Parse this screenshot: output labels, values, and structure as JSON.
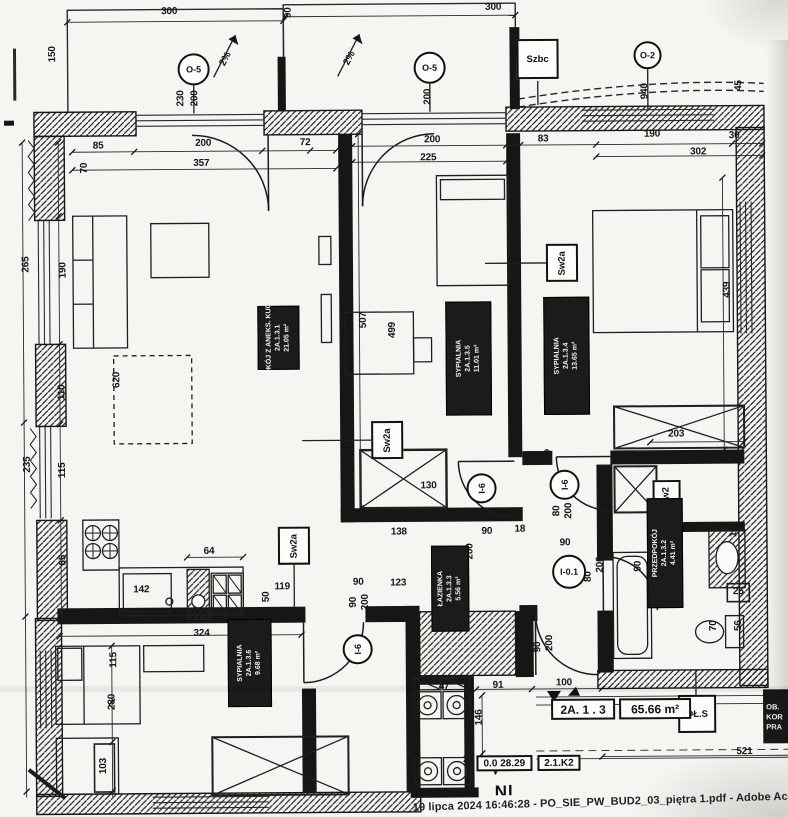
{
  "footer": "19 lipca 2024 16:46:28 - PO_SIE_PW_BUD2_03_piętra 1.pdf - Adobe Acrobat Read",
  "apartment": {
    "unit": "2A. 1 . 3",
    "area": "65.66 m²"
  },
  "marks": {
    "elevation_prefix": "0.0",
    "elevation_value": "28.29",
    "section_tag": "2.1.K2",
    "clipped_text": "Nl",
    "edge_stamp": [
      "OB.",
      "KOR",
      "PRA"
    ]
  },
  "plan": {
    "room_labels": [
      {
        "lines": [
          "POKÓJ Z ANEKS. KUCH.",
          "2A.1.3.1",
          "21.05 m²"
        ],
        "x": 258,
        "y": 305,
        "w": 42,
        "h": 64
      },
      {
        "lines": [
          "SYPIALNIA",
          "2A.1.3.5",
          "11.01 m²"
        ],
        "x": 446,
        "y": 302,
        "w": 46,
        "h": 114
      },
      {
        "lines": [
          "SYPIALNIA",
          "2A.1.3.4",
          "13.65 m²"
        ],
        "x": 544,
        "y": 298,
        "w": 46,
        "h": 118
      },
      {
        "lines": [
          "ŁAZIENKA",
          "2A.1.3.3",
          "5.56 m²"
        ],
        "x": 430,
        "y": 546,
        "w": 38,
        "h": 86
      },
      {
        "lines": [
          "PRZEDPOKÓJ",
          "2A.1.3.2",
          "4.41 m²"
        ],
        "x": 646,
        "y": 500,
        "w": 36,
        "h": 110
      },
      {
        "lines": [
          "SYPIALNIA",
          "2A.1.3.6",
          "9.68 m²"
        ],
        "x": 226,
        "y": 618,
        "w": 44,
        "h": 88
      }
    ],
    "square_tags": [
      {
        "t": "Szbc",
        "x": 540,
        "y": 60,
        "w": 42,
        "h": 40,
        "rot": 0
      },
      {
        "t": "Sw2a",
        "x": 563,
        "y": 264,
        "w": 32,
        "h": 38,
        "rot": -90
      },
      {
        "t": "Sw2a",
        "x": 387,
        "y": 440,
        "w": 32,
        "h": 38,
        "rot": -90
      },
      {
        "t": "Sw2a",
        "x": 293,
        "y": 545,
        "w": 32,
        "h": 38,
        "rot": -90
      },
      {
        "t": "Sw2",
        "x": 666,
        "y": 498,
        "w": 28,
        "h": 32,
        "rot": -90
      },
      {
        "t": "DŁ.S",
        "x": 695,
        "y": 716,
        "w": 38,
        "h": 38,
        "rot": 0
      }
    ],
    "circle_tags": [
      {
        "t": "O-5",
        "x": 196,
        "y": 68,
        "d": 32,
        "rot": 0
      },
      {
        "t": "O-5",
        "x": 432,
        "y": 68,
        "d": 32,
        "rot": 0
      },
      {
        "t": "O-2",
        "x": 650,
        "y": 57,
        "d": 28,
        "rot": 0
      },
      {
        "t": "I-6",
        "x": 481,
        "y": 489,
        "d": 30,
        "rot": -90
      },
      {
        "t": "I-6",
        "x": 564,
        "y": 486,
        "d": 30,
        "rot": -90
      },
      {
        "t": "I-6",
        "x": 356,
        "y": 649,
        "d": 30,
        "rot": -90
      },
      {
        "t": "I-0.1",
        "x": 568,
        "y": 573,
        "d": 34,
        "rot": 0
      }
    ],
    "dimensions": [
      {
        "t": "300",
        "x": 172,
        "y": 10
      },
      {
        "t": "90",
        "x": 291,
        "y": 12,
        "r": -90
      },
      {
        "t": "300",
        "x": 496,
        "y": 8
      },
      {
        "t": "150",
        "x": 55,
        "y": 52,
        "r": -90
      },
      {
        "t": "2%",
        "x": 228,
        "y": 58,
        "r": -62
      },
      {
        "t": "2%",
        "x": 352,
        "y": 58,
        "r": -62
      },
      {
        "t": "230",
        "x": 183,
        "y": 97,
        "r": -90
      },
      {
        "t": "200",
        "x": 197,
        "y": 97,
        "r": -90
      },
      {
        "t": "200",
        "x": 430,
        "y": 97,
        "r": -90
      },
      {
        "t": "940",
        "x": 647,
        "y": 93,
        "r": -90
      },
      {
        "t": "45",
        "x": 741,
        "y": 88,
        "r": -90
      },
      {
        "t": "85",
        "x": 100,
        "y": 144
      },
      {
        "t": "200",
        "x": 205,
        "y": 142
      },
      {
        "t": "72",
        "x": 307,
        "y": 142
      },
      {
        "t": "25",
        "x": 345,
        "y": 144
      },
      {
        "t": "200",
        "x": 434,
        "y": 140
      },
      {
        "t": "83",
        "x": 545,
        "y": 140
      },
      {
        "t": "190",
        "x": 654,
        "y": 136
      },
      {
        "t": "30",
        "x": 736,
        "y": 138
      },
      {
        "t": "70",
        "x": 86,
        "y": 166,
        "r": -90
      },
      {
        "t": "357",
        "x": 203,
        "y": 162
      },
      {
        "t": "225",
        "x": 430,
        "y": 158
      },
      {
        "t": "302",
        "x": 700,
        "y": 154
      },
      {
        "t": "265",
        "x": 27,
        "y": 262,
        "r": -90
      },
      {
        "t": "190",
        "x": 64,
        "y": 268,
        "r": -90
      },
      {
        "t": "620",
        "x": 117,
        "y": 378,
        "r": -90
      },
      {
        "t": "110",
        "x": 62,
        "y": 390,
        "r": -90
      },
      {
        "t": "235",
        "x": 27,
        "y": 462,
        "r": -90
      },
      {
        "t": "115",
        "x": 62,
        "y": 468,
        "r": -90
      },
      {
        "t": "65",
        "x": 62,
        "y": 558,
        "r": -90
      },
      {
        "t": "507",
        "x": 364,
        "y": 320,
        "r": -90
      },
      {
        "t": "499",
        "x": 393,
        "y": 330,
        "r": -90
      },
      {
        "t": "439",
        "x": 728,
        "y": 292,
        "r": -90
      },
      {
        "t": "203",
        "x": 676,
        "y": 436
      },
      {
        "t": "130",
        "x": 428,
        "y": 486
      },
      {
        "t": "60",
        "x": 546,
        "y": 456,
        "r": -48
      },
      {
        "t": "138",
        "x": 398,
        "y": 532
      },
      {
        "t": "90",
        "x": 486,
        "y": 532
      },
      {
        "t": "18",
        "x": 519,
        "y": 530
      },
      {
        "t": "80",
        "x": 456,
        "y": 552,
        "r": -90
      },
      {
        "t": "200",
        "x": 469,
        "y": 552,
        "r": -90
      },
      {
        "t": "80",
        "x": 556,
        "y": 512,
        "r": -90
      },
      {
        "t": "200",
        "x": 568,
        "y": 512,
        "r": -90
      },
      {
        "t": "90",
        "x": 564,
        "y": 544
      },
      {
        "t": "200",
        "x": 599,
        "y": 566,
        "r": -90
      },
      {
        "t": "80",
        "x": 587,
        "y": 578,
        "r": -90
      },
      {
        "t": "90",
        "x": 637,
        "y": 568,
        "r": -90
      },
      {
        "t": "18",
        "x": 733,
        "y": 534,
        "r": -90
      },
      {
        "t": "25",
        "x": 737,
        "y": 594
      },
      {
        "t": "56",
        "x": 737,
        "y": 628,
        "r": -90
      },
      {
        "t": "70",
        "x": 712,
        "y": 628,
        "r": -90
      },
      {
        "t": "64",
        "x": 208,
        "y": 550
      },
      {
        "t": "142",
        "x": 140,
        "y": 588
      },
      {
        "t": "119",
        "x": 281,
        "y": 586
      },
      {
        "t": "50",
        "x": 265,
        "y": 596,
        "r": -90
      },
      {
        "t": "90",
        "x": 357,
        "y": 582
      },
      {
        "t": "123",
        "x": 397,
        "y": 583
      },
      {
        "t": "90",
        "x": 352,
        "y": 602,
        "r": -90
      },
      {
        "t": "200",
        "x": 364,
        "y": 602,
        "r": -90
      },
      {
        "t": "156",
        "x": 452,
        "y": 628
      },
      {
        "t": "324",
        "x": 200,
        "y": 632
      },
      {
        "t": "115",
        "x": 112,
        "y": 658,
        "r": -90
      },
      {
        "t": "230",
        "x": 110,
        "y": 700,
        "r": -90
      },
      {
        "t": "103",
        "x": 101,
        "y": 764,
        "r": -90
      },
      {
        "t": "47",
        "x": 442,
        "y": 687
      },
      {
        "t": "91",
        "x": 496,
        "y": 686
      },
      {
        "t": "100",
        "x": 562,
        "y": 684
      },
      {
        "t": "146",
        "x": 477,
        "y": 718,
        "r": -90
      },
      {
        "t": "20",
        "x": 466,
        "y": 760
      },
      {
        "t": "521",
        "x": 742,
        "y": 754
      },
      {
        "t": "200",
        "x": 548,
        "y": 644,
        "r": -90
      },
      {
        "t": "90",
        "x": 536,
        "y": 648,
        "r": -90
      }
    ]
  }
}
